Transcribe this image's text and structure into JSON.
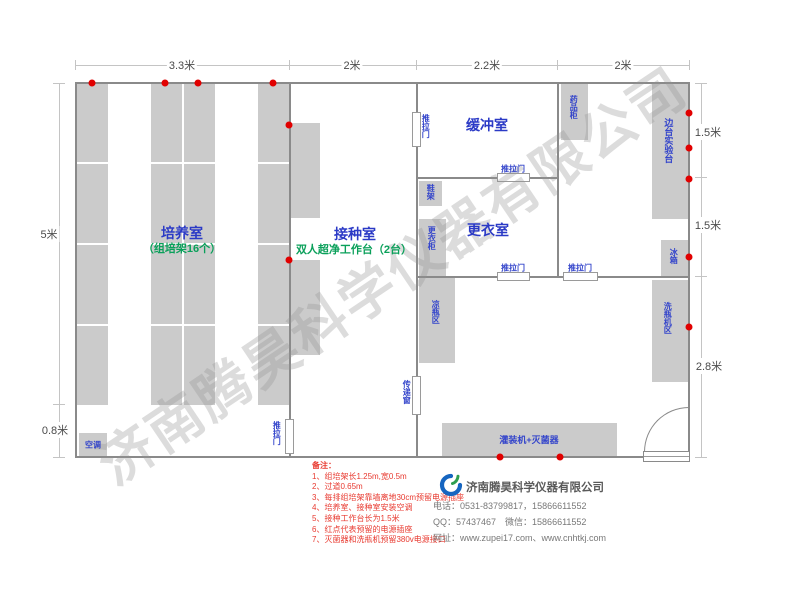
{
  "watermark": "济南腾昊科学仪器有限公司",
  "dimensions": {
    "top": {
      "d1": "3.3米",
      "d2": "2米",
      "d3": "2.2米",
      "d4": "2米"
    },
    "left": {
      "d1": "5米",
      "d2": "0.8米"
    },
    "right": {
      "d1": "1.5米",
      "d2": "1.5米",
      "d3": "2.8米"
    }
  },
  "rooms": {
    "culture": {
      "name": "培养室",
      "subtitle": "（组培架16个）"
    },
    "inoculation": {
      "name": "接种室",
      "subtitle": "双人超净工作台（2台）"
    },
    "buffer": {
      "name": "缓冲室"
    },
    "changing": {
      "name": "更衣室"
    }
  },
  "labels": {
    "sliding_door": "推拉门",
    "transfer_window": "传递窗",
    "medicine_cabinet": "药品柜",
    "shoe_rack": "鞋架",
    "wardrobe": "更衣柜",
    "cool_bottle_area": "凉瓶区",
    "side_bench": "边台实验台",
    "fridge": "冰箱",
    "bottle_washer_area": "洗瓶机区",
    "filling_machine": "灌装机+灭菌器",
    "air_conditioner": "空调"
  },
  "notes": {
    "title": "备注：",
    "items": [
      "1、组培架长1.25m,宽0.5m",
      "2、过道0.65m",
      "3、每排组培架靠墙离地30cm预留电源插座",
      "4、培养室、接种室安装空调",
      "5、接种工作台长为1.5米",
      "6、红点代表预留的电源插座",
      "7、灭菌器和洗瓶机预留380v电源接口"
    ]
  },
  "company": {
    "name": "济南腾昊科学仪器有限公司",
    "phone": "电话：0531-83799817，15866611552",
    "qq_wechat": "QQ：57437467　微信：15866611552",
    "website": "网址：www.zupei17.com、www.cnhtkj.com"
  },
  "colors": {
    "room_text_blue": "#2b3ac6",
    "subtitle_green": "#0aa05a",
    "note_red": "#e83a30",
    "outlet_dot_red": "#e10000",
    "rack_gray": "#cbcbcb",
    "wall_gray": "#8a8a8a"
  }
}
